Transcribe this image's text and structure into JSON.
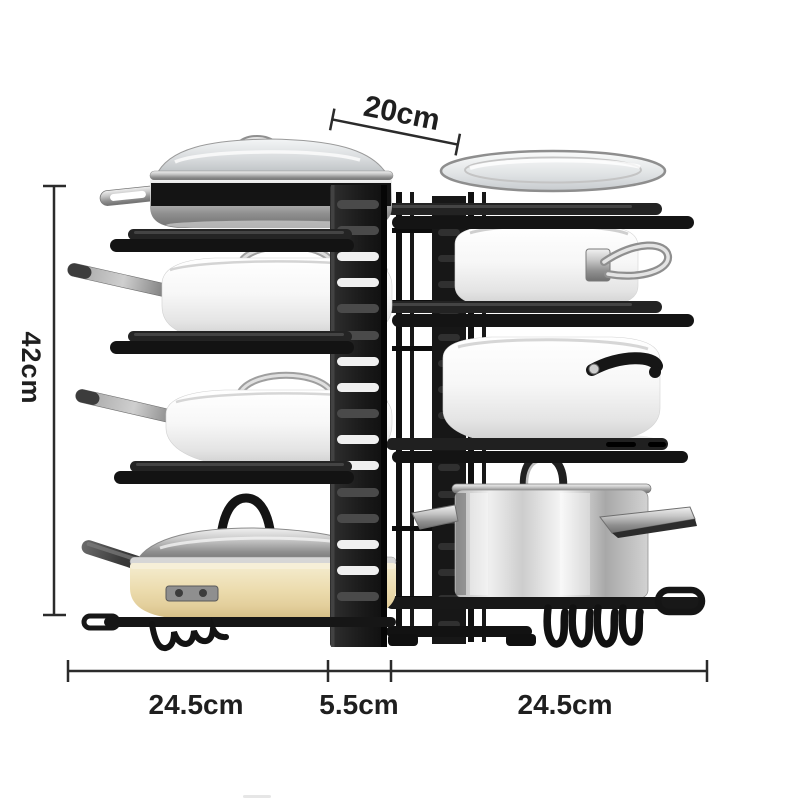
{
  "scene": {
    "background": "#ffffff",
    "subject": "black metal 8-tier adjustable pot and pan organizer rack holding cookware",
    "annotations": {
      "top_width": "20cm",
      "height": "42cm",
      "bottom_left_width": "24.5cm",
      "bottom_center_width": "5.5cm",
      "bottom_right_width": "24.5cm"
    },
    "colors": {
      "rack_black": "#161616",
      "dimension_line": "#2b2b2b",
      "dimension_text": "#1f1f1f",
      "white_pot": "#f7f7f7",
      "cream_pan": "#ecdcae",
      "stainless": "#d9d9d9"
    }
  }
}
